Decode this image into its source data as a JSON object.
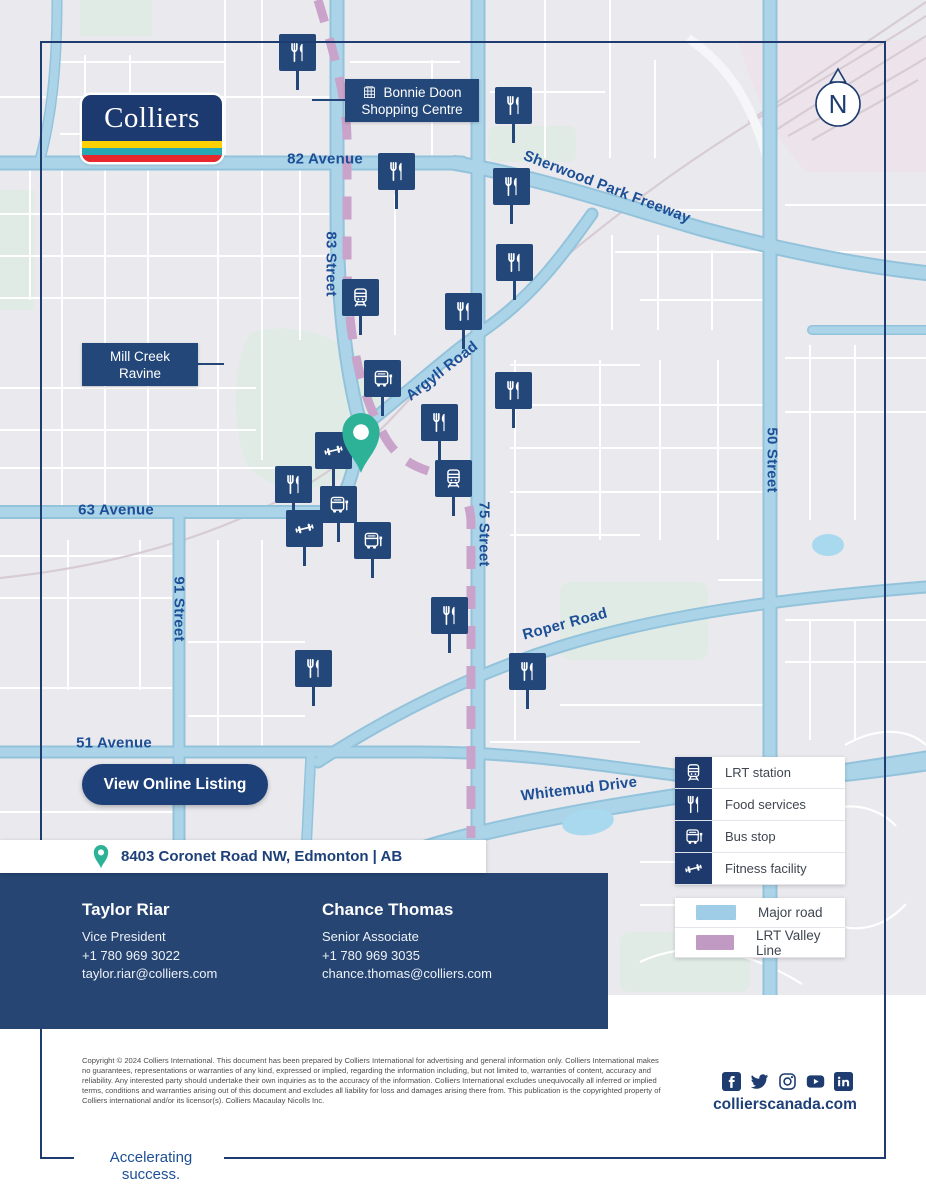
{
  "brand": {
    "wordmark": "Colliers",
    "stripe_colors": [
      "#ffd100",
      "#28a7b5",
      "#e8282d"
    ]
  },
  "colors": {
    "navy": "#1e3c6f",
    "panel_navy": "#264572",
    "road_blue": "#abd4e9",
    "lrt_mauve": "#c9a3ca",
    "pin_teal": "#2db298",
    "label_blue": "#1d4f96"
  },
  "map": {
    "compass_label": "N",
    "callouts": [
      {
        "id": "bonnie-doon",
        "line1": "Bonnie Doon",
        "line2": "Shopping Centre",
        "icon": "building"
      },
      {
        "id": "mill-creek",
        "line1": "Mill Creek",
        "line2": "Ravine",
        "icon": ""
      }
    ],
    "road_labels": [
      {
        "text": "82 Avenue",
        "x": 325,
        "y": 159,
        "rotate": 0
      },
      {
        "text": "83 Street",
        "x": 331,
        "y": 264,
        "rotate": 90
      },
      {
        "text": "Sherwood Park Freeway",
        "x": 607,
        "y": 187,
        "rotate": 21
      },
      {
        "text": "Argyll Road",
        "x": 442,
        "y": 371,
        "rotate": -38
      },
      {
        "text": "75 Street",
        "x": 484,
        "y": 534,
        "rotate": 90
      },
      {
        "text": "50 Street",
        "x": 772,
        "y": 460,
        "rotate": 90
      },
      {
        "text": "63 Avenue",
        "x": 116,
        "y": 510,
        "rotate": 0
      },
      {
        "text": "91 Street",
        "x": 179,
        "y": 609,
        "rotate": 90
      },
      {
        "text": "Roper Road",
        "x": 565,
        "y": 624,
        "rotate": -15
      },
      {
        "text": "51 Avenue",
        "x": 114,
        "y": 743,
        "rotate": 0
      },
      {
        "text": "Whitemud Drive",
        "x": 579,
        "y": 789,
        "rotate": -7
      }
    ],
    "pois": [
      {
        "type": "food",
        "x": 297,
        "y": 52
      },
      {
        "type": "food",
        "x": 513,
        "y": 105
      },
      {
        "type": "food",
        "x": 396,
        "y": 171
      },
      {
        "type": "food",
        "x": 511,
        "y": 186
      },
      {
        "type": "food",
        "x": 514,
        "y": 262
      },
      {
        "type": "lrt",
        "x": 360,
        "y": 297
      },
      {
        "type": "food",
        "x": 463,
        "y": 311
      },
      {
        "type": "bus",
        "x": 382,
        "y": 378
      },
      {
        "type": "food",
        "x": 513,
        "y": 390
      },
      {
        "type": "food",
        "x": 439,
        "y": 422
      },
      {
        "type": "fitness",
        "x": 333,
        "y": 450
      },
      {
        "type": "lrt",
        "x": 453,
        "y": 478
      },
      {
        "type": "food",
        "x": 293,
        "y": 484
      },
      {
        "type": "bus",
        "x": 338,
        "y": 504
      },
      {
        "type": "fitness",
        "x": 304,
        "y": 528
      },
      {
        "type": "bus",
        "x": 372,
        "y": 540
      },
      {
        "type": "food",
        "x": 449,
        "y": 615
      },
      {
        "type": "food",
        "x": 313,
        "y": 668
      },
      {
        "type": "food",
        "x": 527,
        "y": 671
      }
    ],
    "pin": {
      "x": 361,
      "y": 431
    }
  },
  "legend": {
    "poi_items": [
      {
        "type": "lrt",
        "label": "LRT station"
      },
      {
        "type": "food",
        "label": "Food services"
      },
      {
        "type": "bus",
        "label": "Bus stop"
      },
      {
        "type": "fitness",
        "label": "Fitness facility"
      }
    ],
    "line_items": [
      {
        "swatch": "#9fcce6",
        "label": "Major road"
      },
      {
        "swatch": "#c09ac2",
        "label": "LRT Valley Line"
      }
    ]
  },
  "cta": {
    "label": "View Online Listing"
  },
  "address_bar": {
    "text": "8403 Coronet Road NW, Edmonton | AB"
  },
  "contacts": [
    {
      "name": "Taylor Riar",
      "title": "Vice President",
      "phone": "+1 780 969 3022",
      "email": "taylor.riar@colliers.com"
    },
    {
      "name": "Chance Thomas",
      "title": "Senior Associate",
      "phone": "+1 780 969 3035",
      "email": "chance.thomas@colliers.com"
    }
  ],
  "footer": {
    "copyright": "Copyright © 2024 Colliers International. This document has been prepared by Colliers International for advertising and general information only. Colliers International makes no guarantees, representations or warranties of any kind, expressed or implied, regarding the information including, but not limited to, warranties of content, accuracy and reliability. Any interested party should undertake their own inquiries as to the accuracy of the information. Colliers International excludes unequivocally all inferred or implied terms, conditions and warranties arising out of this document and excludes all liability for loss and damages arising there from. This publication is the copyrighted property of Colliers international and/or its licensor(s). Colliers Macaulay Nicolls Inc.",
    "social": [
      "facebook",
      "twitter",
      "instagram",
      "youtube",
      "linkedin"
    ],
    "website": "collierscanada.com",
    "tagline": "Accelerating success."
  }
}
